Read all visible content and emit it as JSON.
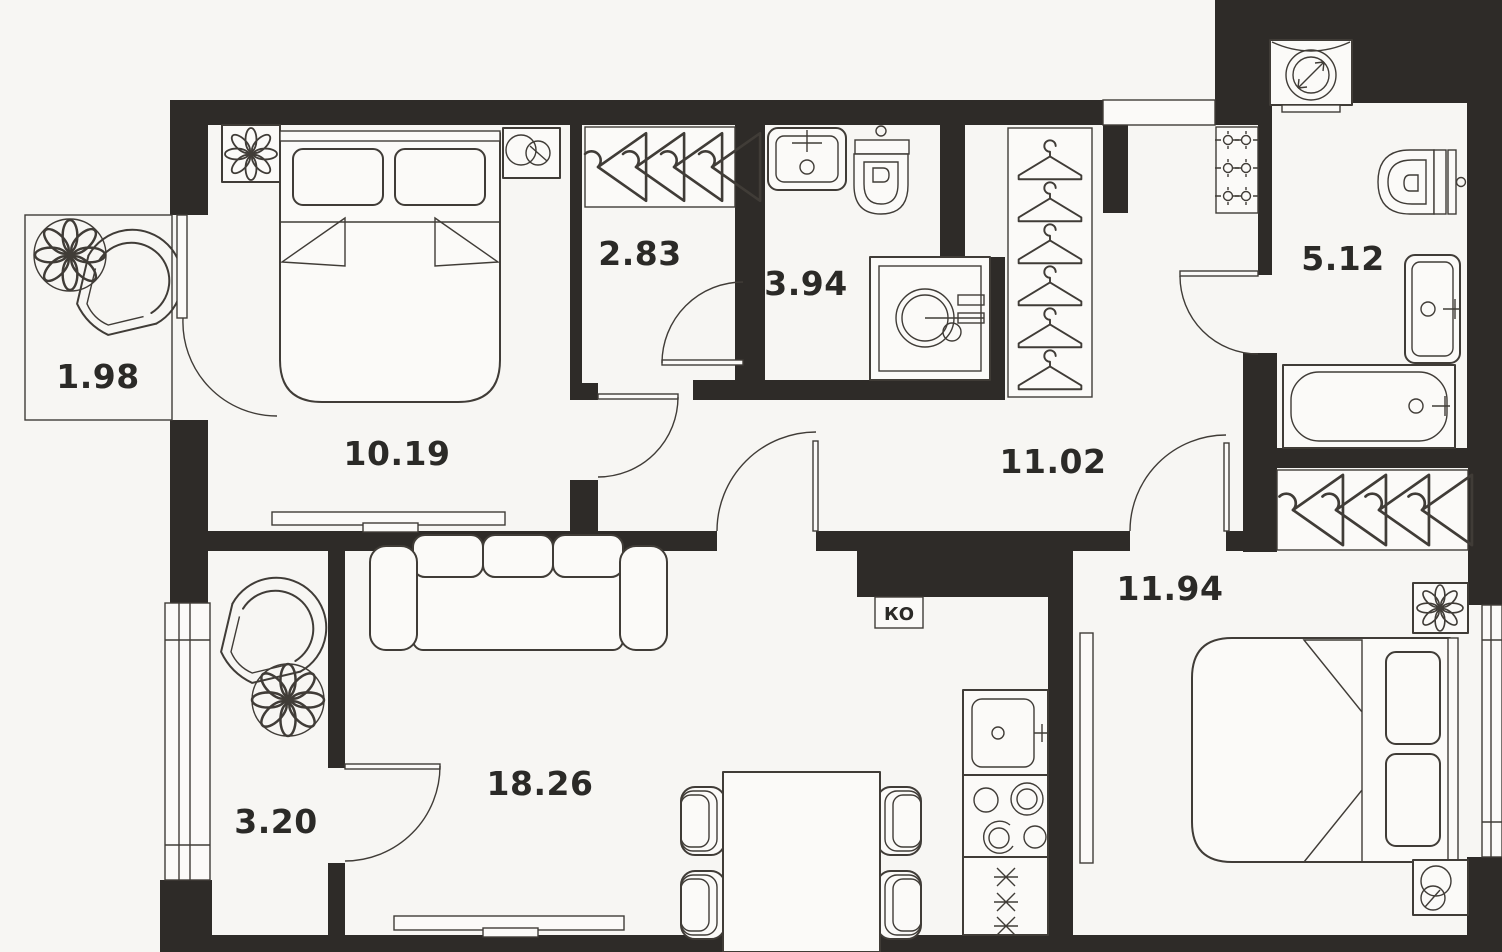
{
  "rooms": {
    "balcony_small": {
      "area": "1.98"
    },
    "bedroom_1": {
      "area": "10.19"
    },
    "wardrobe": {
      "area": "2.83"
    },
    "bathroom_small": {
      "area": "3.94"
    },
    "hallway": {
      "area": "11.02"
    },
    "bathroom_large": {
      "area": "5.12"
    },
    "bedroom_2": {
      "area": "11.94"
    },
    "balcony_large": {
      "area": "3.20"
    },
    "living_kitchen": {
      "area": "18.26"
    }
  },
  "shaft": {
    "label": "КО"
  },
  "colors": {
    "background": "#f7f6f3",
    "wall": "#2e2b28",
    "line": "#403c37",
    "label": "#2b2a27",
    "fixture": "#fbfaf8"
  }
}
